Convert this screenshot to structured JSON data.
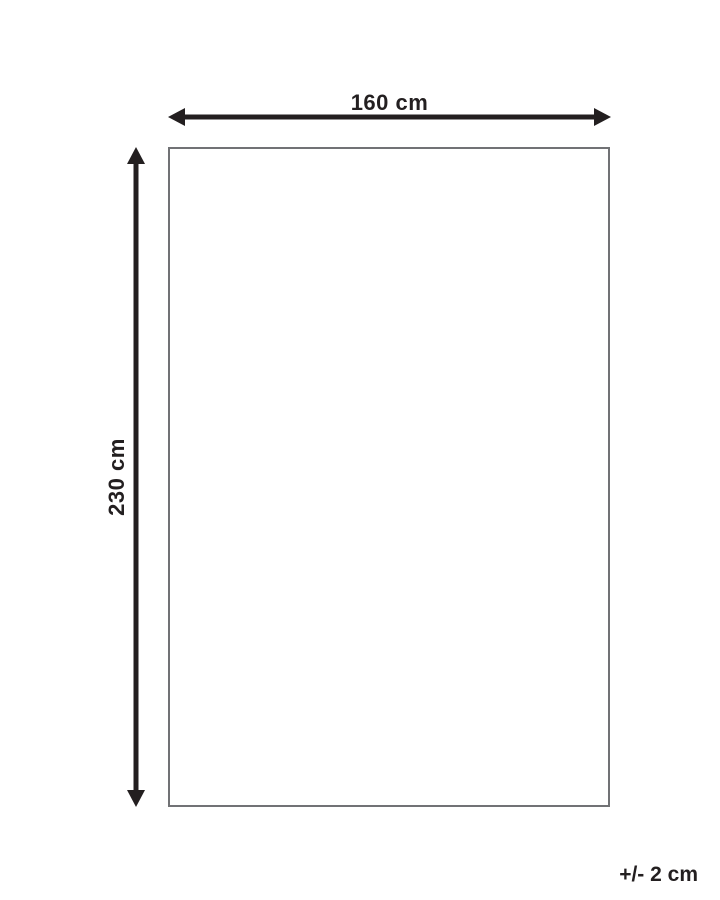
{
  "diagram": {
    "width_label": "160 cm",
    "height_label": "230 cm",
    "tolerance_label": "+/- 2 cm"
  },
  "colors": {
    "ink": "#231f20",
    "outline": "#717275",
    "background": "#ffffff"
  }
}
